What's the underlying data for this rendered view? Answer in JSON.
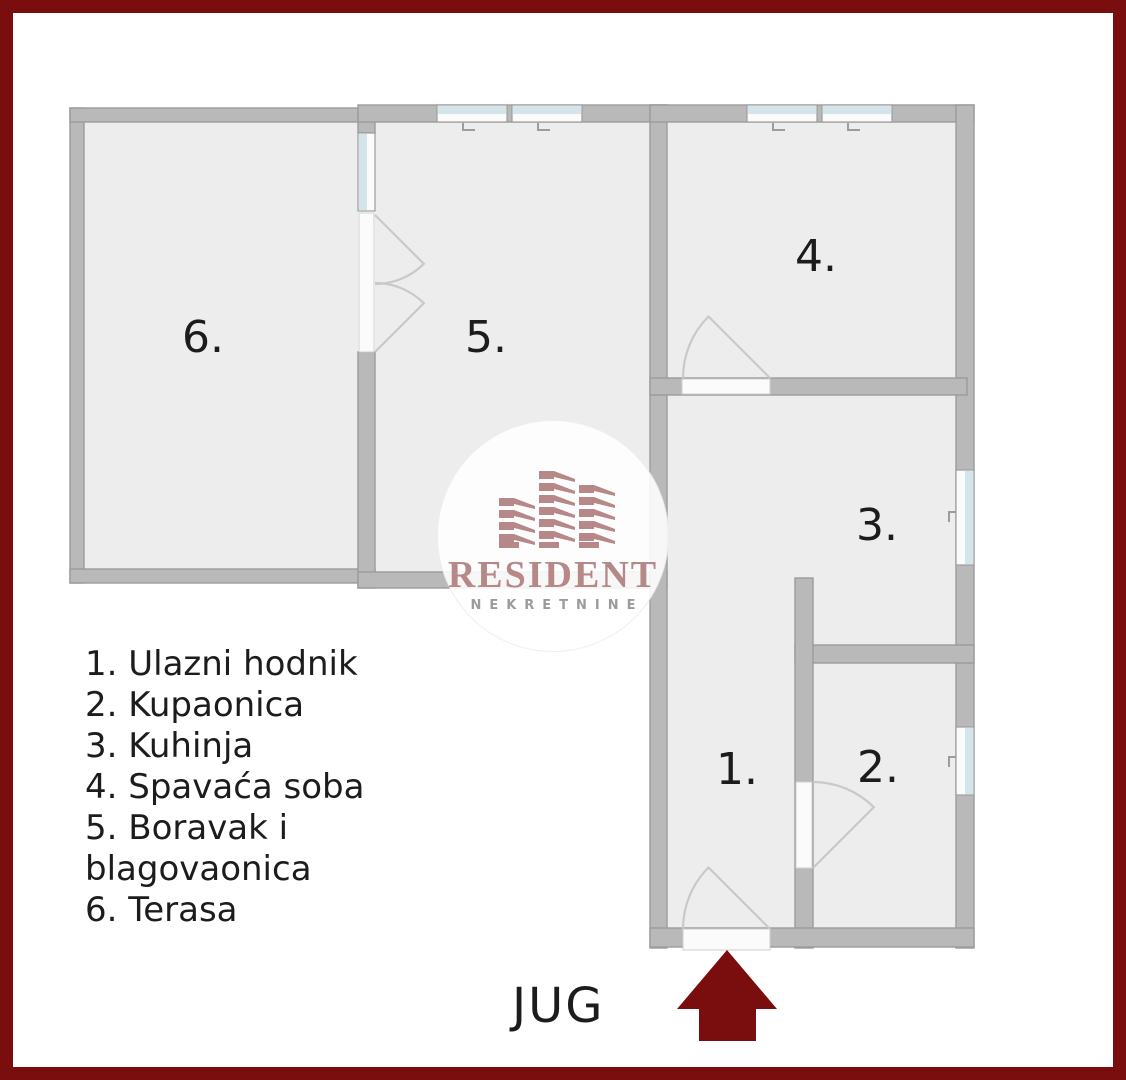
{
  "colors": {
    "frame": "#7a0d0d",
    "wall": "#b9b9b9",
    "wall_edge": "#9c9c9c",
    "floor": "#ededed",
    "glass": "#d4e4eb",
    "opening": "#fbfbfb",
    "arc": "#c9c9c9",
    "ink": "#1c1c1c",
    "brand": "#b68888",
    "subtitle": "#9b9b9b"
  },
  "plan": {
    "room_labels": [
      {
        "label": "6."
      },
      {
        "label": "5."
      },
      {
        "label": "4."
      },
      {
        "label": "3."
      },
      {
        "label": "1."
      },
      {
        "label": "2."
      }
    ]
  },
  "legend": {
    "lines": [
      "1. Ulazni hodnik",
      "2. Kupaonica",
      "3. Kuhinja",
      "4. Spavaća soba",
      "5. Boravak i",
      "blagovaonica",
      "6. Terasa"
    ]
  },
  "compass": {
    "label": "JUG"
  },
  "watermark": {
    "brand": "RESIDENT",
    "subtitle": "NEKRETNINE"
  }
}
